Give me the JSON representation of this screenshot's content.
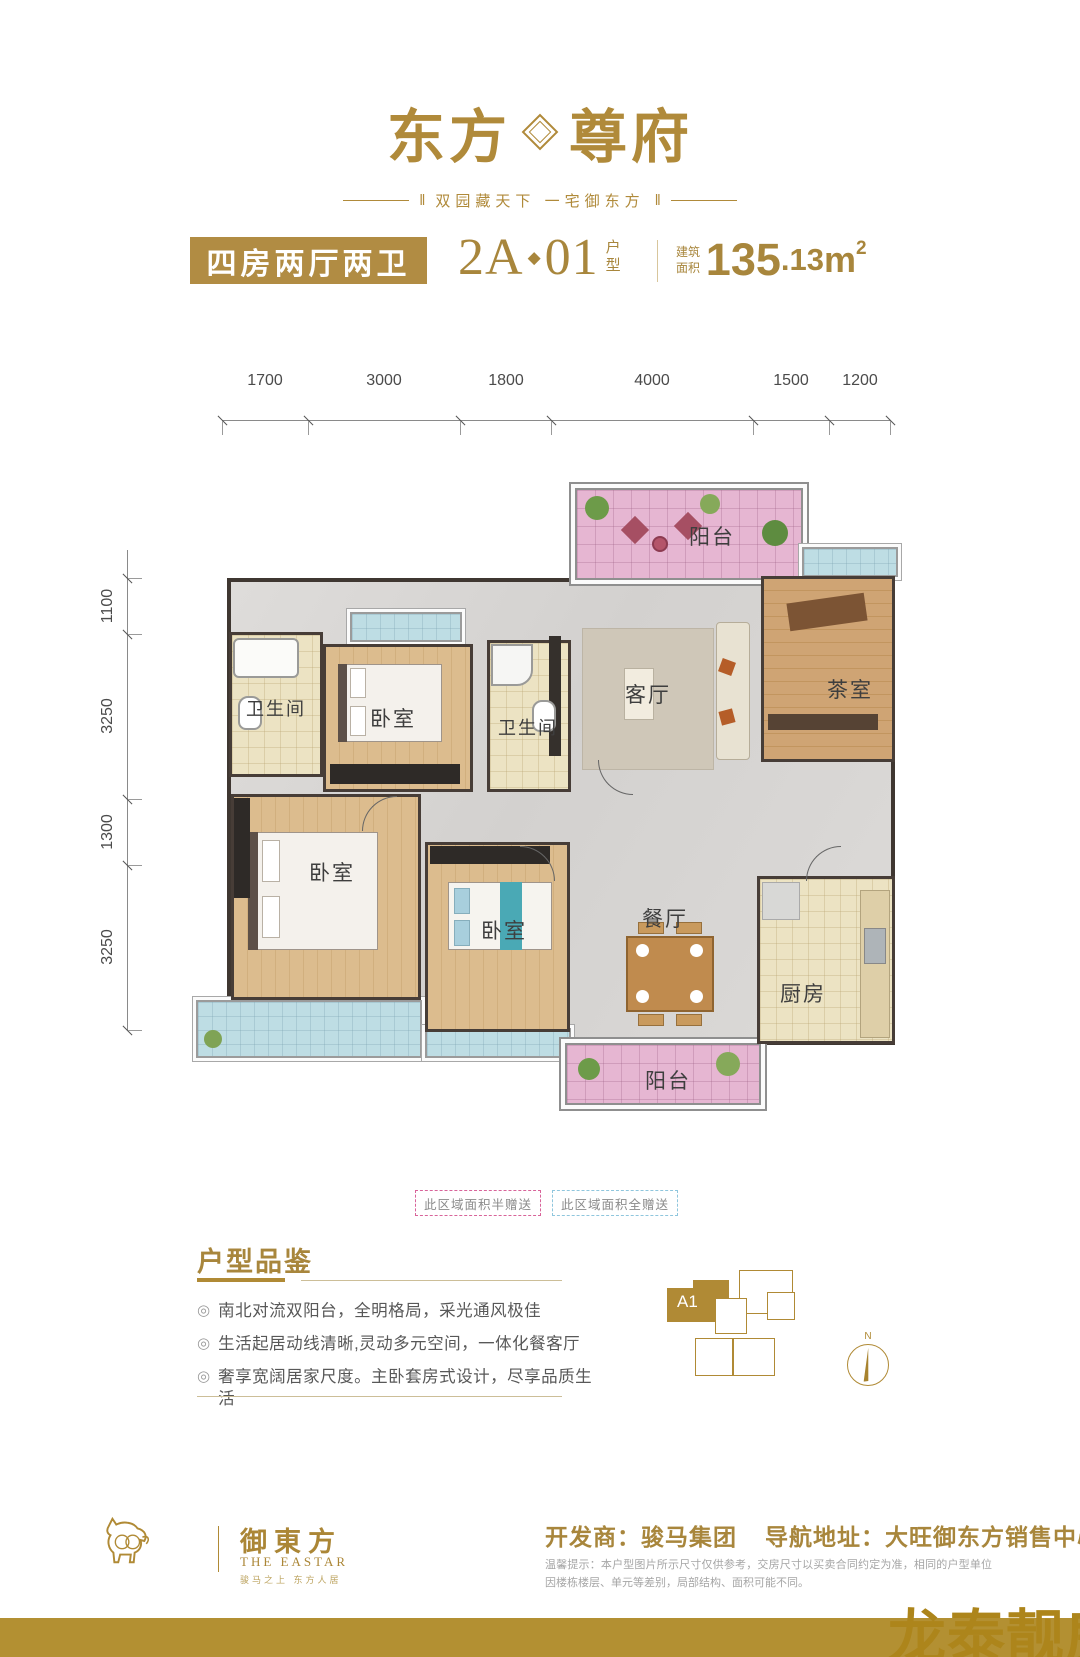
{
  "brand": {
    "name_left": "东方",
    "name_right": "尊府",
    "tag_bar": "‖",
    "tagline": "双园藏天下  一宅御东方"
  },
  "header": {
    "type_name": "四房两厅两卫",
    "unit_main": "2A",
    "unit_sep": "◆",
    "unit_no": "01",
    "unit_suffix": "户型",
    "area_prefix": "建筑面积",
    "area_int": "135",
    "area_dec": ".13",
    "area_unit": "m",
    "area_exp": "2"
  },
  "dims": {
    "top": [
      "1700",
      "3000",
      "1800",
      "4000",
      "1500",
      "1200"
    ],
    "left": [
      "1100",
      "3250",
      "1300",
      "3250"
    ]
  },
  "rooms": {
    "balcony_top": "阳台",
    "tea": "茶室",
    "living": "客厅",
    "bath1": "卫生间",
    "bed1": "卧室",
    "bath2": "卫生间",
    "bed2": "卧室",
    "bed3": "卧室",
    "dining": "餐厅",
    "kitchen": "厨房",
    "balcony_bottom": "阳台"
  },
  "legend": {
    "half": "此区域面积半赠送",
    "full": "此区域面积全赠送",
    "half_color": "#d8649a",
    "full_color": "#8fc6dd"
  },
  "features": {
    "title": "户型品鉴",
    "bullet": "◎",
    "items": [
      "南北对流双阳台，全明格局，采光通风极佳",
      "生活起居动线清晰,灵动多元空间，一体化餐客厅",
      "奢享宽阔居家尺度。主卧套房式设计，尽享品质生活"
    ]
  },
  "keyplan": {
    "unit": "A1",
    "north": "N"
  },
  "footer": {
    "brand_cn": "御東方",
    "brand_en": "THE EASTAR",
    "brand_sub": "骏马之上  东方人居",
    "developer": "开发商：骏马集团",
    "address": "导航地址：大旺御东方销售中心",
    "disclaimer": "温馨提示：本户型图片所示尺寸仅供参考，交房尺寸以买卖合同约定为准，相同的户型单位因楼栋楼层、单元等差别，局部结构、面积可能不同。"
  },
  "watermark": {
    "text": "龙泰靓房"
  },
  "colors": {
    "gold": "#b18c43",
    "band_gold": "#b39032",
    "balcony_pink": "#e6b6d2",
    "bay_blue": "#bedde4"
  }
}
